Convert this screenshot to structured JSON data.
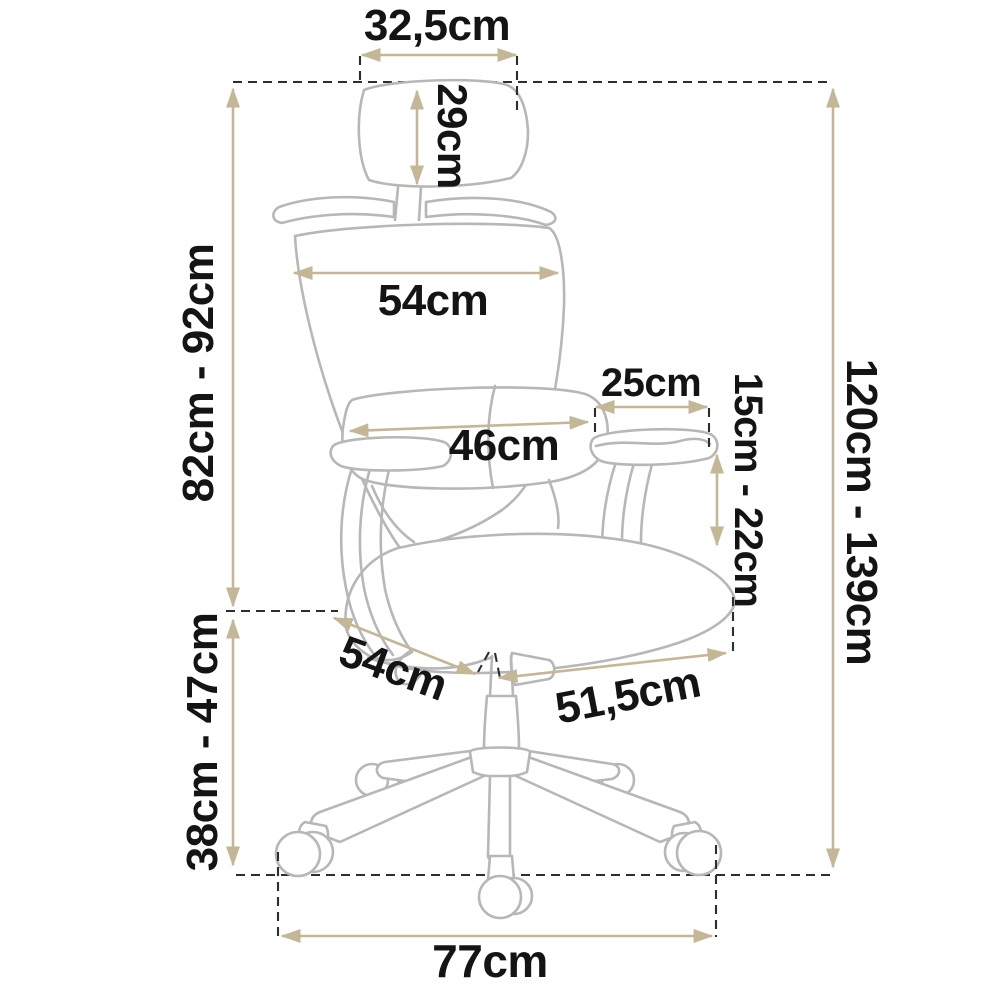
{
  "diagram": {
    "subject": "office-chair-dimension-diagram",
    "unit": "cm",
    "labels": {
      "headrest_width": "32,5cm",
      "headrest_height": "29cm",
      "backrest_width": "54cm",
      "back_height_range": "82cm - 92cm",
      "armrest_pad_length": "25cm",
      "lumbar_width": "46cm",
      "armrest_height_range": "15cm - 22cm",
      "total_height_range": "120cm - 139cm",
      "seat_depth": "54cm",
      "seat_width": "51,5cm",
      "seat_height_range": "38cm - 47cm",
      "base_width": "77cm"
    },
    "colors": {
      "dimension": "#c3b795",
      "outline": "#b7b7b7",
      "dashed": "#2e2e2e",
      "text": "#141414",
      "background": "#ffffff"
    }
  }
}
